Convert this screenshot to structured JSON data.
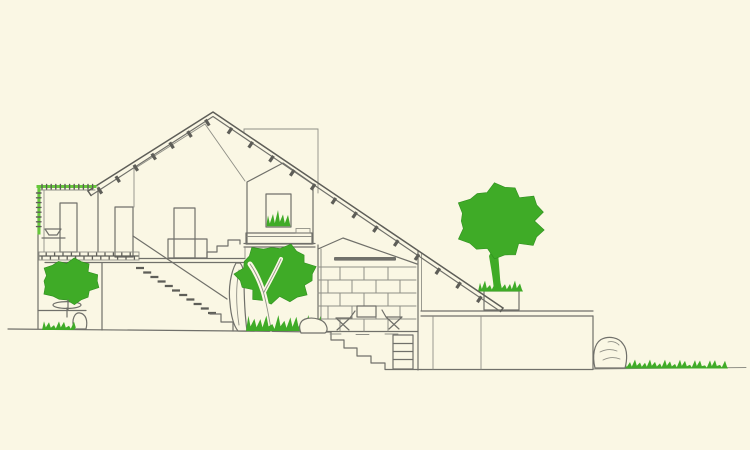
{
  "meta": {
    "description": "Hand-drawn architectural cross-section sketch of a hillside house with sloping roof, interior rooms, stairs, stone wall, terrace and green trees on cream paper"
  },
  "colors": {
    "background": "#FAF7E4",
    "line": "#70706A",
    "line_dark": "#5E5E58",
    "line_light": "#8F8F86",
    "foliage": "#3FAB27",
    "foliage_dark": "#2F8F1F",
    "highlight_green": "#66C83B"
  },
  "scene": {
    "roof": {
      "left_rafter_count": 7,
      "right_rafter_count": 13
    },
    "stone_wall": {
      "rows": 5,
      "row_height": 13,
      "x_start": 322,
      "x_end": 416,
      "y_top": 267
    },
    "interior_stair": {
      "tread_dashes": 11
    },
    "outdoor_steps": {
      "count": 5
    },
    "trees": [
      {
        "name": "left-planter-tree"
      },
      {
        "name": "courtyard-tree"
      },
      {
        "name": "terrace-planter-tree"
      }
    ],
    "elements": [
      "left-wing-with-green-parapet",
      "upper-floor-rooms",
      "wash-basin",
      "interior-doors",
      "long-open-stair",
      "boulder",
      "dormer-room-with-window-and-bed",
      "stone-masonry-room-with-table-and-chairs",
      "basement-ladder",
      "outdoor-steps",
      "terrace-wall",
      "rock",
      "grass-strip",
      "chimney-volume",
      "rafter-ticks"
    ]
  }
}
